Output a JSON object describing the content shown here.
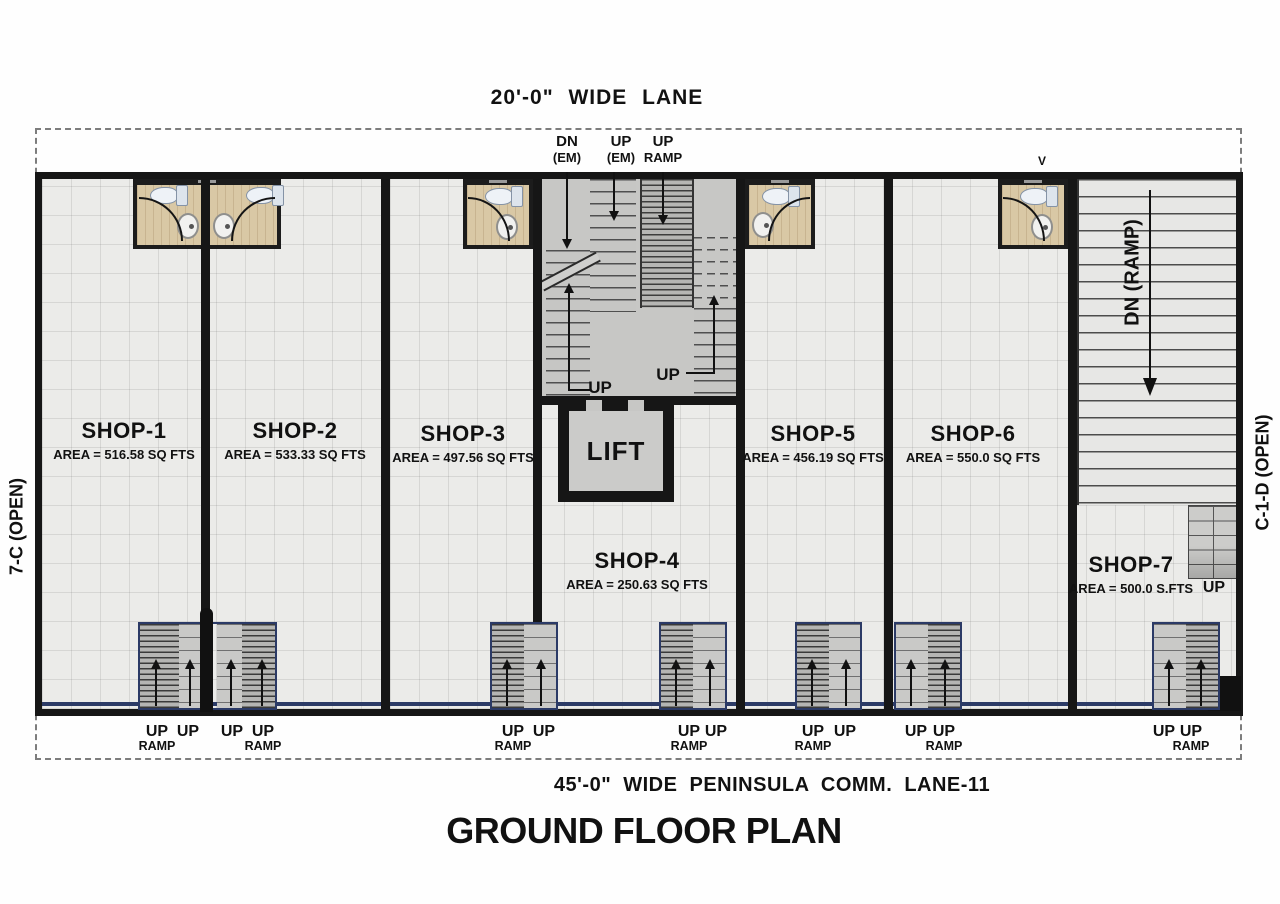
{
  "title": "GROUND FLOOR PLAN",
  "lanes": {
    "top": "20'-0\"  WIDE  LANE",
    "bottom": "45'-0\"  WIDE  PENINSULA  COMM. LANE-11"
  },
  "side_labels": {
    "left": "7-C  (OPEN)",
    "right": "C-1-D  (OPEN)",
    "ramp": "DN (RAMP)"
  },
  "core": {
    "dn_em_top": "DN",
    "dn_em_bottom": "(EM)",
    "up_em_top": "UP",
    "up_em_bottom": "(EM)",
    "up_ramp_top": "UP",
    "up_ramp_bottom": "RAMP",
    "up_left": "UP",
    "up_right": "UP",
    "lift": "LIFT"
  },
  "misc": {
    "vent_marker": "V"
  },
  "shops": [
    {
      "name": "SHOP-1",
      "area": "AREA = 516.58  SQ FTS"
    },
    {
      "name": "SHOP-2",
      "area": "AREA = 533.33  SQ FTS"
    },
    {
      "name": "SHOP-3",
      "area": "AREA = 497.56  SQ FTS"
    },
    {
      "name": "SHOP-4",
      "area": "AREA = 250.63  SQ FTS"
    },
    {
      "name": "SHOP-5",
      "area": "AREA = 456.19  SQ FTS"
    },
    {
      "name": "SHOP-6",
      "area": "AREA = 550.0  SQ FTS"
    },
    {
      "name": "SHOP-7",
      "area": "AREA = 500.0  S.FTS",
      "up": "UP"
    }
  ],
  "entries": [
    {
      "up": "UP",
      "sub": "RAMP"
    },
    {
      "up": "UP",
      "sub": ""
    },
    {
      "up": "UP",
      "sub": ""
    },
    {
      "up": "UP",
      "sub": "RAMP"
    },
    {
      "up": "UP",
      "sub": "RAMP"
    },
    {
      "up": "UP",
      "sub": ""
    },
    {
      "up": "UP",
      "sub": "RAMP"
    },
    {
      "up": "UP",
      "sub": ""
    },
    {
      "up": "UP",
      "sub": "RAMP"
    },
    {
      "up": "UP",
      "sub": ""
    },
    {
      "up": "UP",
      "sub": ""
    },
    {
      "up": "UP",
      "sub": "RAMP"
    },
    {
      "up": "UP",
      "sub": ""
    },
    {
      "up": "UP",
      "sub": "RAMP"
    }
  ],
  "colors": {
    "wall": "#161616",
    "accent_blue": "#2b3a66",
    "bath_floor": "#d9c8a5",
    "tile_floor": "#ebebe9",
    "core_floor": "#c7c7c5"
  }
}
